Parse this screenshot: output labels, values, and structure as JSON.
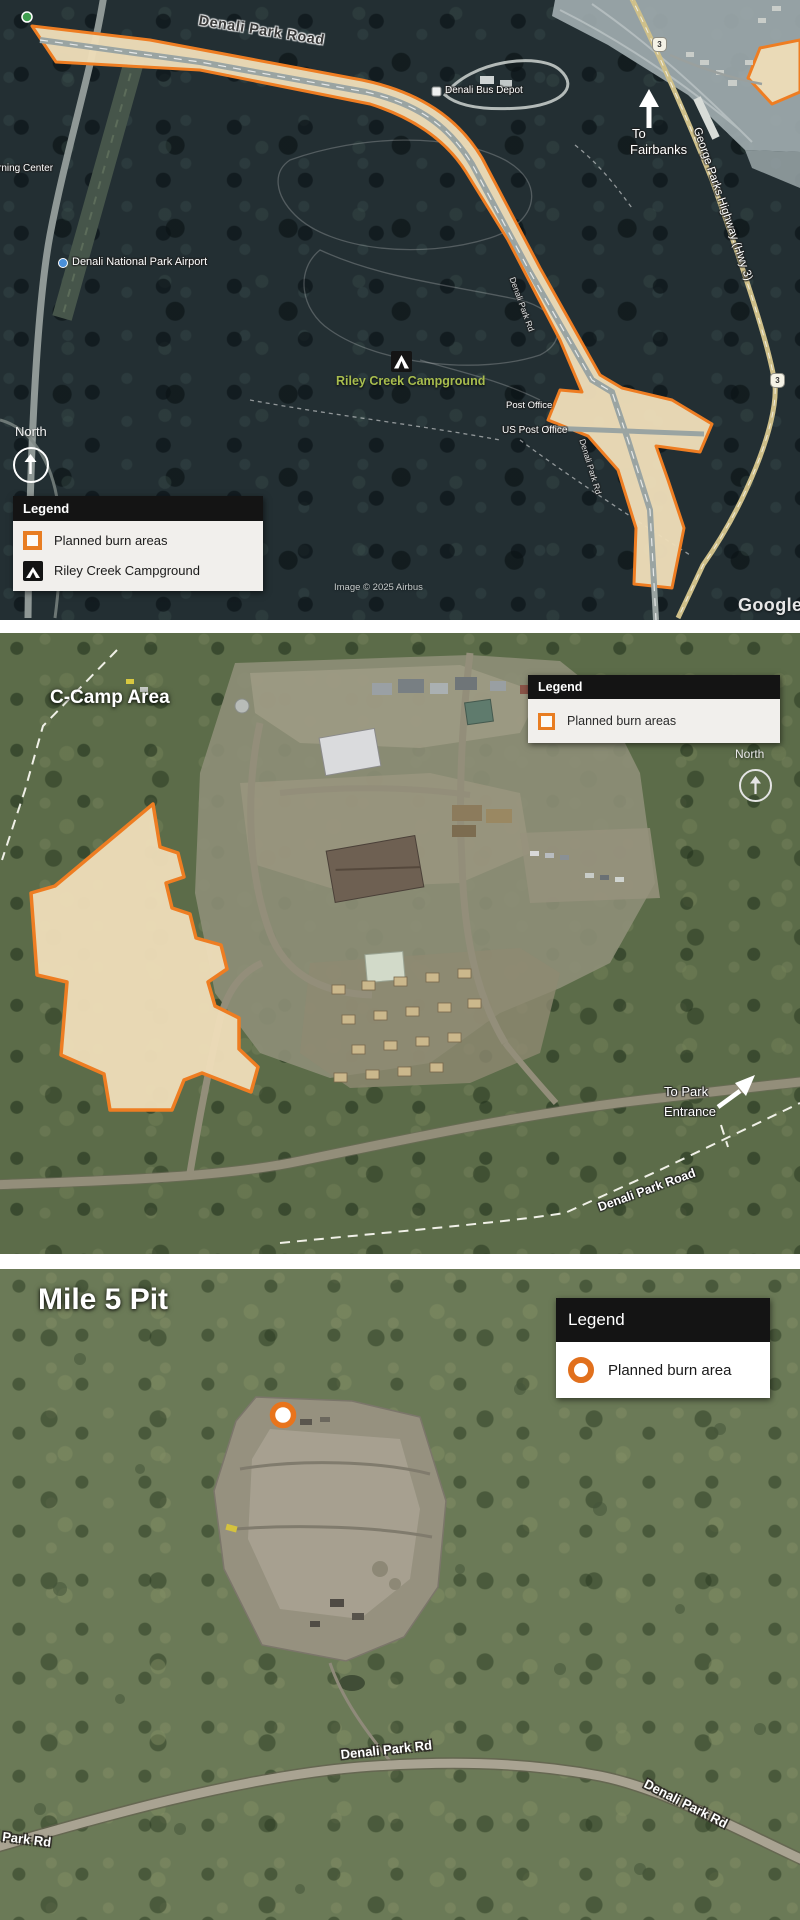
{
  "overview_map": {
    "road_label": "Denali Park Road",
    "partial_left_label": "rning Center",
    "airport_label": "Denali National Park Airport",
    "bus_depot_label": "Denali Bus Depot",
    "campground_label": "Riley Creek Campground",
    "post_office_label": "Post Office",
    "us_post_office_label": "US Post Office",
    "inline_road_label": "Denali Park Rd",
    "to_fairbanks_line1": "To",
    "to_fairbanks_line2": "Fairbanks",
    "highway_label": "George Parks Highway (Hwy 3)",
    "route_shield": "3",
    "north_label": "North",
    "legend_title": "Legend",
    "legend_items": [
      {
        "swatch": "orange-square-outline",
        "label": "Planned burn areas"
      },
      {
        "swatch": "campground-tent-icon",
        "label": "Riley Creek Campground"
      }
    ],
    "imagery_credit": "Image © 2025 Airbus",
    "watermark": "Google E"
  },
  "ccamp_map": {
    "title": "C-Camp Area",
    "legend_title": "Legend",
    "legend_items": [
      {
        "swatch": "orange-square-outline",
        "label": "Planned burn areas"
      }
    ],
    "north_label": "North",
    "to_park_entrance_line1": "To Park",
    "to_park_entrance_line2": "Entrance",
    "road_label": "Denali Park Road"
  },
  "mile5_map": {
    "title": "Mile 5 Pit",
    "legend_title": "Legend",
    "legend_items": [
      {
        "swatch": "orange-ring",
        "label": "Planned burn area"
      }
    ],
    "road_label_1": "Denali Park Rd",
    "road_label_2": "Denali Park Rd",
    "road_label_partial": "i Park Rd"
  },
  "colors": {
    "burn_outline": "#EE7D22",
    "burn_fill": "#ECDCB8",
    "legend_header_bg": "#141414",
    "campground_label_green": "#A8BD4E"
  }
}
